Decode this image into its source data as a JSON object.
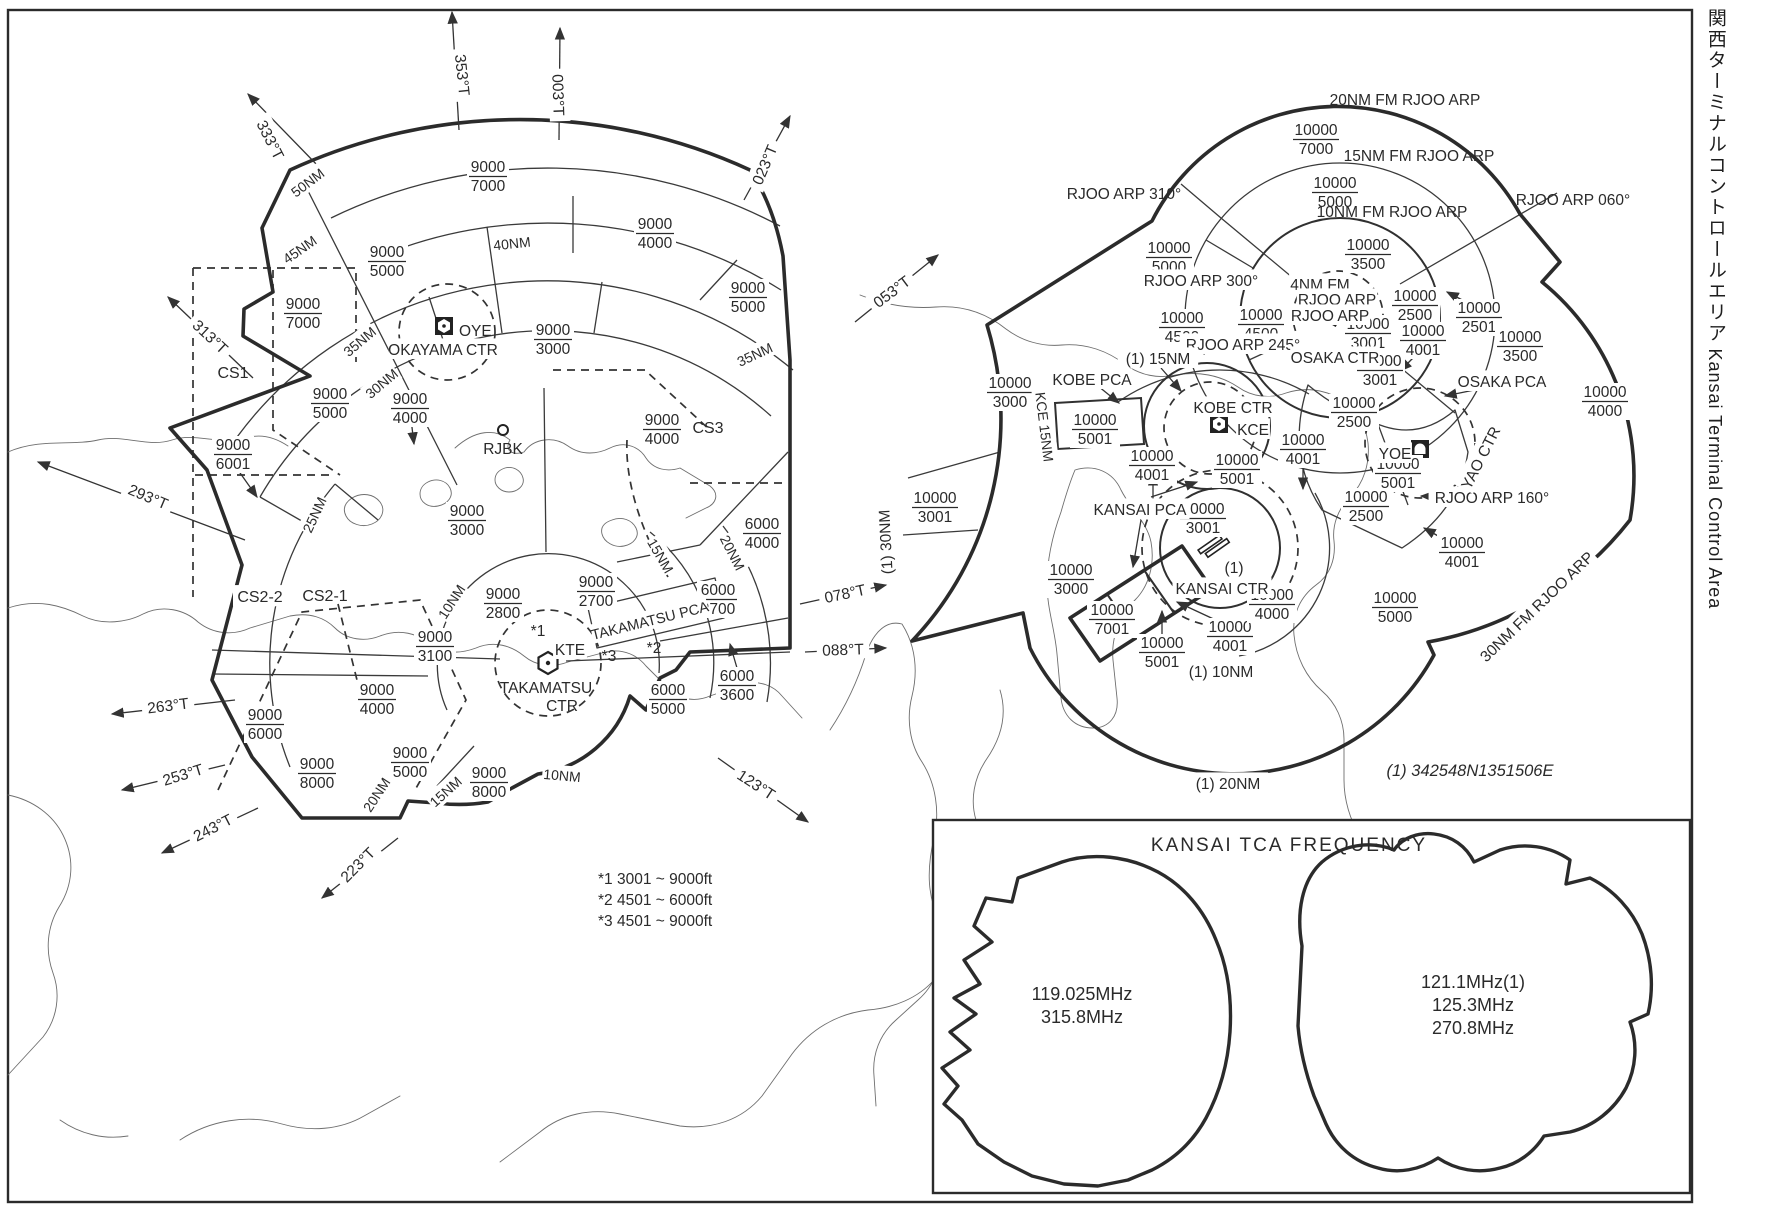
{
  "title": {
    "ja": "関西ターミナルコントロールエリア",
    "en": "Kansai Terminal Control Area"
  },
  "note": "(1) 342548N1351506E",
  "legend": {
    "items": [
      "*1  3001 ~ 9000ft",
      "*2  4501 ~ 6000ft",
      "*3  4501 ~ 9000ft"
    ]
  },
  "frequency_box": {
    "title": "KANSAI TCA FREQUENCY",
    "west": [
      "119.025MHz",
      "315.8MHz"
    ],
    "east": [
      "121.1MHz(1)",
      "125.3MHz",
      "270.8MHz"
    ]
  },
  "colors": {
    "ink": "#2a2a2a",
    "background": "#ffffff"
  },
  "labels": [
    {
      "t": "333°T",
      "x": 270,
      "y": 140,
      "r": 63,
      "bg": 1
    },
    {
      "t": "353°T",
      "x": 462,
      "y": 75,
      "r": 84,
      "bg": 1
    },
    {
      "t": "003°T",
      "x": 558,
      "y": 95,
      "r": 88,
      "bg": 1
    },
    {
      "t": "023°T",
      "x": 765,
      "y": 165,
      "r": -67,
      "bg": 1
    },
    {
      "t": "313°T",
      "x": 210,
      "y": 337,
      "r": 43,
      "bg": 1
    },
    {
      "t": "293°T",
      "x": 148,
      "y": 497,
      "r": 23,
      "bg": 1
    },
    {
      "t": "263°T",
      "x": 168,
      "y": 706,
      "r": -7,
      "bg": 1
    },
    {
      "t": "253°T",
      "x": 183,
      "y": 775,
      "r": -17,
      "bg": 1
    },
    {
      "t": "243°T",
      "x": 213,
      "y": 828,
      "r": -27,
      "bg": 1
    },
    {
      "t": "223°T",
      "x": 358,
      "y": 865,
      "r": -45,
      "bg": 1
    },
    {
      "t": "123°T",
      "x": 756,
      "y": 785,
      "r": 33,
      "bg": 1
    },
    {
      "t": "053°T",
      "x": 892,
      "y": 292,
      "r": -37,
      "bg": 1
    },
    {
      "t": "078°T",
      "x": 845,
      "y": 594,
      "r": -12,
      "bg": 1
    },
    {
      "t": "088°T",
      "x": 843,
      "y": 650,
      "r": -2,
      "bg": 1
    },
    {
      "t": "50NM",
      "x": 308,
      "y": 183,
      "r": -37,
      "fs": 14,
      "bg": 1
    },
    {
      "t": "45NM",
      "x": 300,
      "y": 250,
      "r": -35,
      "fs": 14,
      "bg": 1
    },
    {
      "t": "40NM",
      "x": 512,
      "y": 244,
      "r": -6,
      "fs": 14,
      "bg": 1
    },
    {
      "t": "35NM",
      "x": 360,
      "y": 342,
      "r": -40,
      "fs": 14,
      "bg": 1
    },
    {
      "t": "30NM",
      "x": 382,
      "y": 384,
      "r": -40,
      "fs": 14,
      "bg": 1
    },
    {
      "t": "35NM",
      "x": 755,
      "y": 355,
      "r": -25,
      "fs": 14,
      "bg": 1
    },
    {
      "t": "25NM",
      "x": 315,
      "y": 515,
      "r": -65,
      "fs": 14,
      "bg": 1
    },
    {
      "t": "10NM",
      "x": 452,
      "y": 602,
      "r": -57,
      "fs": 14,
      "bg": 1
    },
    {
      "t": "15NM",
      "x": 660,
      "y": 556,
      "r": 60,
      "fs": 14,
      "bg": 1
    },
    {
      "t": "20NM",
      "x": 732,
      "y": 553,
      "r": 63,
      "fs": 14,
      "bg": 1
    },
    {
      "t": "10NM",
      "x": 562,
      "y": 776,
      "r": 5,
      "fs": 14,
      "bg": 1
    },
    {
      "t": "15NM",
      "x": 446,
      "y": 792,
      "r": -42,
      "fs": 14,
      "bg": 1
    },
    {
      "t": "20NM",
      "x": 377,
      "y": 795,
      "r": -57,
      "fs": 14,
      "bg": 1
    },
    {
      "t": "CS1",
      "x": 233,
      "y": 373,
      "fs": 16
    },
    {
      "t": "CS2-2",
      "x": 260,
      "y": 597,
      "fs": 16,
      "bg": 1
    },
    {
      "t": "CS2-1",
      "x": 325,
      "y": 596,
      "fs": 16
    },
    {
      "t": "CS3",
      "x": 708,
      "y": 428,
      "fs": 16
    },
    {
      "t": "OYE",
      "x": 459,
      "y": 331,
      "a": "start"
    },
    {
      "t": "OKAYAMA CTR",
      "x": 443,
      "y": 350,
      "bg": 1
    },
    {
      "t": "RJBK",
      "x": 503,
      "y": 449
    },
    {
      "t": "KTE",
      "x": 570,
      "y": 650,
      "bg": 1
    },
    {
      "t": "TAKAMATSU",
      "x": 546,
      "y": 688
    },
    {
      "t": "CTR",
      "x": 562,
      "y": 706
    },
    {
      "t": "*1",
      "x": 538,
      "y": 631
    },
    {
      "t": "*3",
      "x": 609,
      "y": 656
    },
    {
      "t": "*2",
      "x": 654,
      "y": 648
    },
    {
      "t": "TAKAMATSU PCA",
      "x": 650,
      "y": 621,
      "r": -14,
      "fs": 14.5,
      "bg": 1
    },
    {
      "t": "20NM FM RJOO ARP",
      "x": 1405,
      "y": 100
    },
    {
      "t": "15NM FM RJOO ARP",
      "x": 1419,
      "y": 156
    },
    {
      "t": "10NM FM RJOO ARP",
      "x": 1392,
      "y": 212
    },
    {
      "t": "RJOO ARP 310°",
      "x": 1124,
      "y": 194
    },
    {
      "t": "RJOO ARP 300°",
      "x": 1201,
      "y": 281,
      "bg": 1
    },
    {
      "t": "RJOO ARP 245°",
      "x": 1243,
      "y": 345,
      "bg": 1
    },
    {
      "t": "RJOO ARP 060°",
      "x": 1573,
      "y": 200
    },
    {
      "t": "RJOO ARP 160°",
      "x": 1492,
      "y": 498,
      "bg": 1
    },
    {
      "t": "4NM FM",
      "x": 1320,
      "y": 285,
      "bg": 1
    },
    {
      "t": "RJOO ARP",
      "x": 1337,
      "y": 300,
      "bg": 1
    },
    {
      "t": "RJOO ARP",
      "x": 1330,
      "y": 316,
      "bg": 1
    },
    {
      "t": "OSAKA CTR",
      "x": 1335,
      "y": 358,
      "bg": 1
    },
    {
      "t": "KOBE CTR",
      "x": 1233,
      "y": 408,
      "bg": 1
    },
    {
      "t": "KCE",
      "x": 1253,
      "y": 430,
      "bg": 1
    },
    {
      "t": "YOE",
      "x": 1395,
      "y": 454,
      "bg": 1
    },
    {
      "t": "YAO CTR",
      "x": 1481,
      "y": 458,
      "r": -63,
      "bg": 1
    },
    {
      "t": "OSAKA PCA",
      "x": 1502,
      "y": 382,
      "bg": 1
    },
    {
      "t": "KOBE PCA",
      "x": 1092,
      "y": 380,
      "bg": 1
    },
    {
      "t": "KANSAI PCA",
      "x": 1140,
      "y": 510,
      "bg": 1
    },
    {
      "t": "KANSAI CTR",
      "x": 1222,
      "y": 589,
      "bg": 1
    },
    {
      "t": "(1)",
      "x": 1234,
      "y": 568,
      "bg": 1
    },
    {
      "t": "(1) 10NM",
      "x": 1221,
      "y": 672,
      "bg": 1
    },
    {
      "t": "(1) 20NM",
      "x": 1228,
      "y": 784,
      "bg": 1
    },
    {
      "t": "(1) 15NM",
      "x": 1158,
      "y": 359,
      "bg": 1
    },
    {
      "t": "(1) 30NM",
      "x": 886,
      "y": 542,
      "r": -93,
      "bg": 1
    },
    {
      "t": "KCE 15NM",
      "x": 1044,
      "y": 427,
      "r": 83,
      "fs": 14,
      "bg": 1
    },
    {
      "t": "30NM FM RJOO ARP",
      "x": 1537,
      "y": 607,
      "r": -44,
      "bg": 1
    }
  ],
  "fractions": [
    {
      "u": "9000",
      "l": "7000",
      "x": 488,
      "y": 175
    },
    {
      "u": "9000",
      "l": "4000",
      "x": 655,
      "y": 232
    },
    {
      "u": "9000",
      "l": "5000",
      "x": 387,
      "y": 260
    },
    {
      "u": "9000",
      "l": "7000",
      "x": 303,
      "y": 312
    },
    {
      "u": "9000",
      "l": "5000",
      "x": 748,
      "y": 296
    },
    {
      "u": "9000",
      "l": "3000",
      "x": 553,
      "y": 338
    },
    {
      "u": "9000",
      "l": "5000",
      "x": 330,
      "y": 402
    },
    {
      "u": "9000",
      "l": "4000",
      "x": 410,
      "y": 407
    },
    {
      "u": "9000",
      "l": "6001",
      "x": 233,
      "y": 453
    },
    {
      "u": "9000",
      "l": "4000",
      "x": 662,
      "y": 428
    },
    {
      "u": "9000",
      "l": "3000",
      "x": 467,
      "y": 519
    },
    {
      "u": "9000",
      "l": "2800",
      "x": 503,
      "y": 602
    },
    {
      "u": "9000",
      "l": "2700",
      "x": 596,
      "y": 590
    },
    {
      "u": "9000",
      "l": "3100",
      "x": 435,
      "y": 645
    },
    {
      "u": "6000",
      "l": "4000",
      "x": 762,
      "y": 532
    },
    {
      "u": "6000",
      "l": "2700",
      "x": 718,
      "y": 598
    },
    {
      "u": "6000",
      "l": "3600",
      "x": 737,
      "y": 684
    },
    {
      "u": "6000",
      "l": "5000",
      "x": 668,
      "y": 698
    },
    {
      "u": "9000",
      "l": "4000",
      "x": 377,
      "y": 698
    },
    {
      "u": "9000",
      "l": "6000",
      "x": 265,
      "y": 723
    },
    {
      "u": "9000",
      "l": "5000",
      "x": 410,
      "y": 761
    },
    {
      "u": "9000",
      "l": "8000",
      "x": 317,
      "y": 772
    },
    {
      "u": "9000",
      "l": "8000",
      "x": 489,
      "y": 781
    },
    {
      "u": "10000",
      "l": "7000",
      "x": 1316,
      "y": 138
    },
    {
      "u": "10000",
      "l": "5000",
      "x": 1335,
      "y": 191
    },
    {
      "u": "10000",
      "l": "3500",
      "x": 1368,
      "y": 253
    },
    {
      "u": "10000",
      "l": "5000",
      "x": 1169,
      "y": 256
    },
    {
      "u": "10000",
      "l": "4500",
      "x": 1182,
      "y": 326
    },
    {
      "u": "10000",
      "l": "4500",
      "x": 1261,
      "y": 323
    },
    {
      "u": "10000",
      "l": "2500",
      "x": 1415,
      "y": 304
    },
    {
      "u": "10000",
      "l": "2501",
      "x": 1479,
      "y": 316
    },
    {
      "u": "10000",
      "l": "3500",
      "x": 1520,
      "y": 345
    },
    {
      "u": "10000",
      "l": "4001",
      "x": 1423,
      "y": 339
    },
    {
      "u": "10000",
      "l": "3001",
      "x": 1368,
      "y": 332
    },
    {
      "u": "10000",
      "l": "3001",
      "x": 1380,
      "y": 369
    },
    {
      "u": "10000",
      "l": "2500",
      "x": 1354,
      "y": 411
    },
    {
      "u": "10000",
      "l": "4000",
      "x": 1605,
      "y": 400
    },
    {
      "u": "10000",
      "l": "3000",
      "x": 1010,
      "y": 391
    },
    {
      "u": "10000",
      "l": "5001",
      "x": 1095,
      "y": 428
    },
    {
      "u": "10000",
      "l": "4001",
      "x": 1152,
      "y": 464
    },
    {
      "u": "10000",
      "l": "5001",
      "x": 1237,
      "y": 468
    },
    {
      "u": "10000",
      "l": "4001",
      "x": 1303,
      "y": 448
    },
    {
      "u": "10000",
      "l": "5001",
      "x": 1398,
      "y": 472
    },
    {
      "u": "10000",
      "l": "2500",
      "x": 1366,
      "y": 505
    },
    {
      "u": "10000",
      "l": "3001",
      "x": 935,
      "y": 506
    },
    {
      "u": "10000",
      "l": "3001",
      "x": 1203,
      "y": 517
    },
    {
      "u": "10000",
      "l": "3000",
      "x": 1071,
      "y": 578
    },
    {
      "u": "10000",
      "l": "7001",
      "x": 1112,
      "y": 618
    },
    {
      "u": "10000",
      "l": "4001",
      "x": 1230,
      "y": 635
    },
    {
      "u": "10000",
      "l": "5001",
      "x": 1162,
      "y": 651
    },
    {
      "u": "10000",
      "l": "4000",
      "x": 1272,
      "y": 603
    },
    {
      "u": "10000",
      "l": "4001",
      "x": 1462,
      "y": 551
    },
    {
      "u": "10000",
      "l": "5000",
      "x": 1395,
      "y": 606
    }
  ]
}
